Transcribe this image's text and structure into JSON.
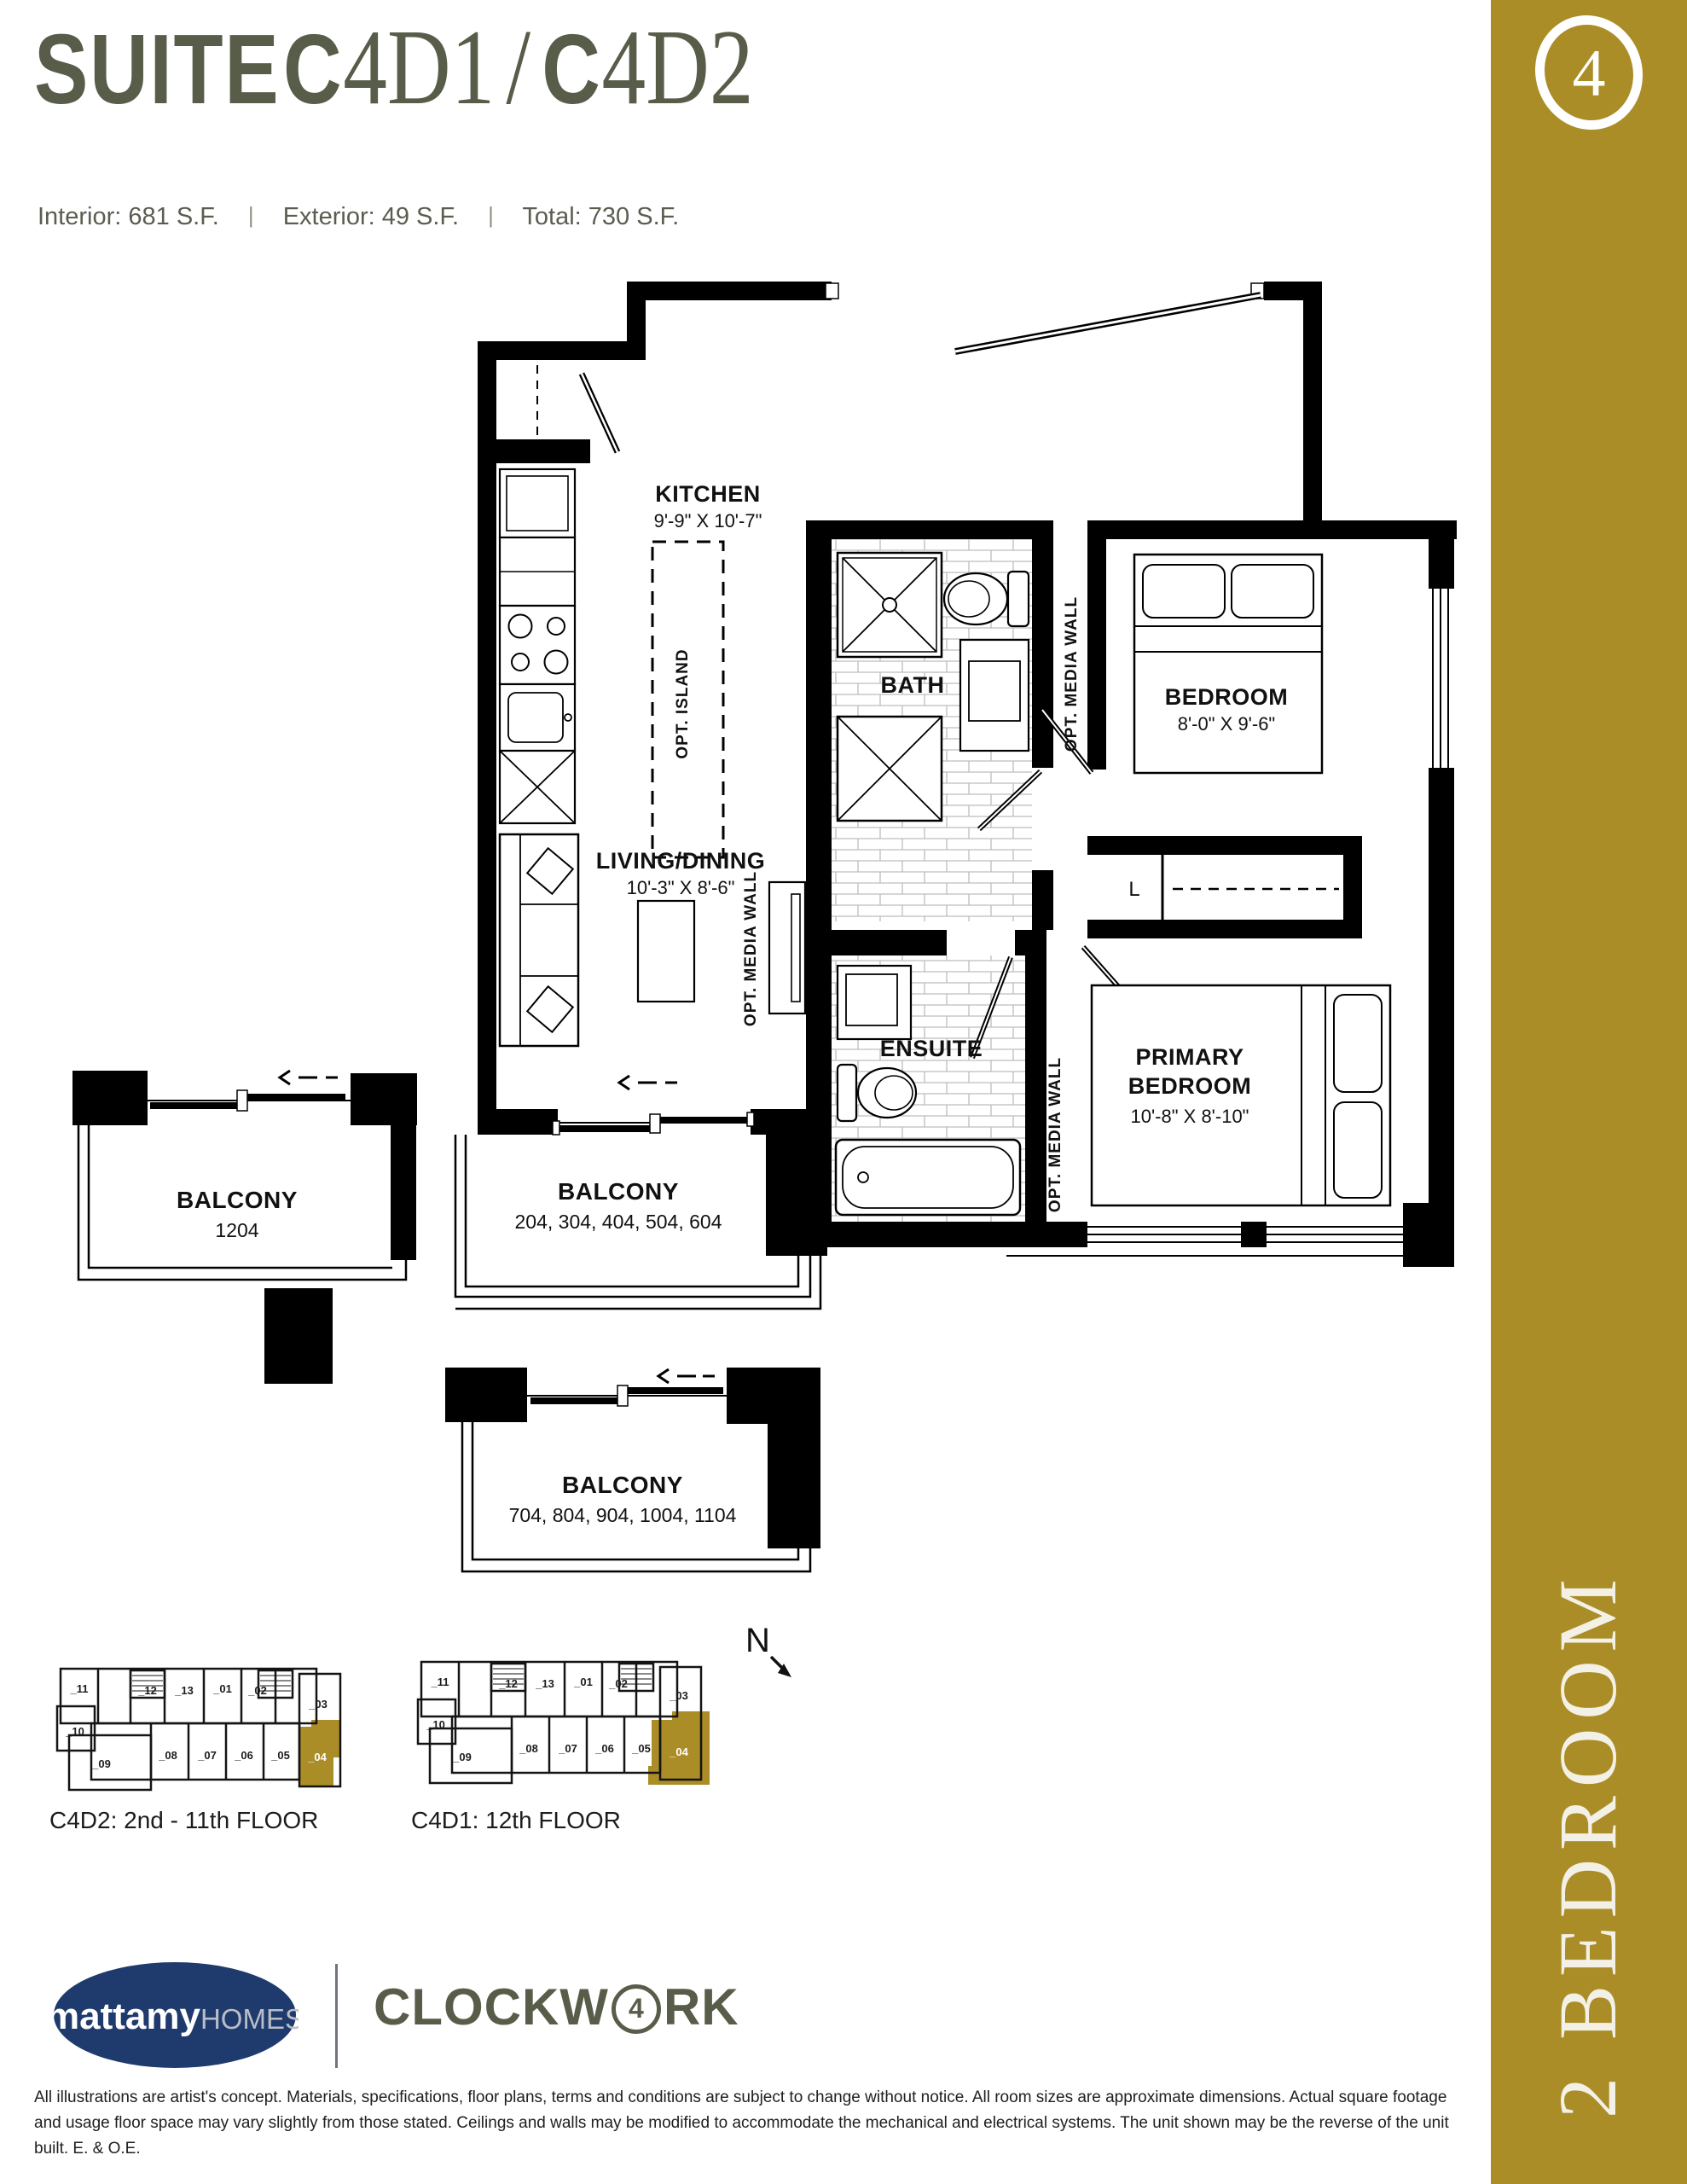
{
  "theme": {
    "gold": "#ab8d27",
    "olive": "#575d49",
    "navy": "#1f3a6d",
    "stats_gray": "#595e4f"
  },
  "header": {
    "title": {
      "suite": "SUITE",
      "c1": "C",
      "n1": "4D1",
      "slash": "/",
      "c2": "C",
      "n2": "4D2"
    },
    "stats": [
      {
        "label": "Interior:",
        "value": "681 S.F."
      },
      {
        "label": "Exterior:",
        "value": "49 S.F."
      },
      {
        "label": "Total:",
        "value": "730 S.F."
      }
    ],
    "stats_divider": "|"
  },
  "sidebar": {
    "badge": "4",
    "label": "2 BEDROOM"
  },
  "floorplan": {
    "rooms": {
      "kitchen": {
        "name": "KITCHEN",
        "dims": "9'-9\" X 10'-7\""
      },
      "bath": {
        "name": "BATH"
      },
      "bedroom": {
        "name": "BEDROOM",
        "dims": "8'-0\" X 9'-6\""
      },
      "living": {
        "name": "LIVING/DINING",
        "dims": "10'-3\" X 8'-6\""
      },
      "ensuite": {
        "name": "ENSUITE"
      },
      "primary": {
        "name1": "PRIMARY",
        "name2": "BEDROOM",
        "dims": "10'-8\" X 8'-10\""
      }
    },
    "notes": {
      "opt_island": "OPT. ISLAND",
      "opt_media_wall": "OPT. MEDIA WALL",
      "linen": "L"
    },
    "balconies": [
      {
        "name": "BALCONY",
        "units": "1204"
      },
      {
        "name": "BALCONY",
        "units": "204, 304, 404, 504, 604"
      },
      {
        "name": "BALCONY",
        "units": "704, 804, 904, 1004, 1104"
      }
    ]
  },
  "keyplans": [
    {
      "caption": "C4D2: 2nd - 11th FLOOR",
      "highlighted_unit": "_04",
      "units": [
        "_11",
        "_12",
        "_13",
        "_01",
        "_02",
        "_03",
        "_10",
        "_09",
        "_08",
        "_07",
        "_06",
        "_05",
        "_04"
      ]
    },
    {
      "caption": "C4D1: 12th FLOOR",
      "highlighted_unit": "_04",
      "units": [
        "_11",
        "_12",
        "_13",
        "_01",
        "_02",
        "_03",
        "_10",
        "_09",
        "_08",
        "_07",
        "_06",
        "_05",
        "_04"
      ]
    }
  ],
  "compass": {
    "label": "N"
  },
  "footer": {
    "brand1": "mattamy",
    "brand2": "HOMES",
    "project1": "CLOCKW",
    "project_badge": "4",
    "project2": "RK",
    "disclaimer": "All illustrations are artist's concept. Materials, specifications, floor plans, terms and conditions are subject to change without notice. All room sizes are approximate dimensions. Actual square footage and usage floor space may vary slightly from those stated. Ceilings and walls may be modified to accommodate the mechanical and electrical systems. The unit shown may be the reverse of the unit built. E. & O.E."
  }
}
